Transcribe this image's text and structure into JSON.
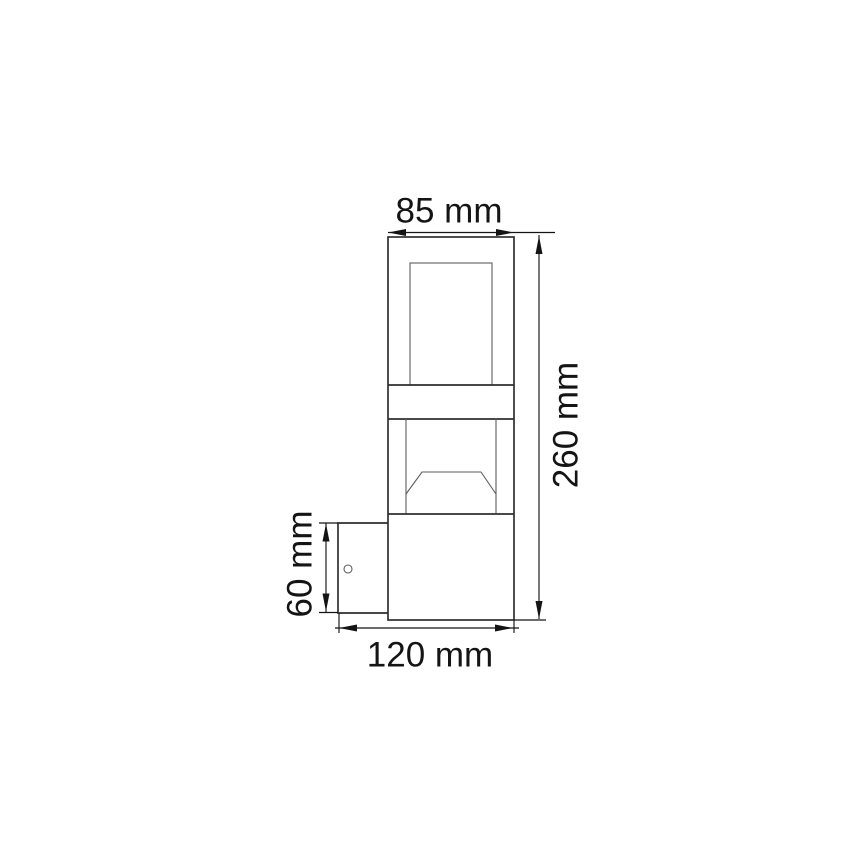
{
  "figure": {
    "kind": "technical-dimension-drawing",
    "units": "mm",
    "background_color": "#ffffff",
    "line_color": "#2f2f2f",
    "detail_line_color": "#5d5d5d",
    "dimension_color": "#141414",
    "text_color": "#141414"
  },
  "dimensions": {
    "body_width": {
      "label": "85 mm",
      "value": 85,
      "unit": "mm",
      "position": "top"
    },
    "overall_height": {
      "label": "260 mm",
      "value": 260,
      "unit": "mm",
      "position": "right"
    },
    "bracket_height": {
      "label": "60 mm",
      "value": 60,
      "unit": "mm",
      "position": "left"
    },
    "overall_depth": {
      "label": "120 mm",
      "value": 120,
      "unit": "mm",
      "position": "bottom"
    }
  }
}
